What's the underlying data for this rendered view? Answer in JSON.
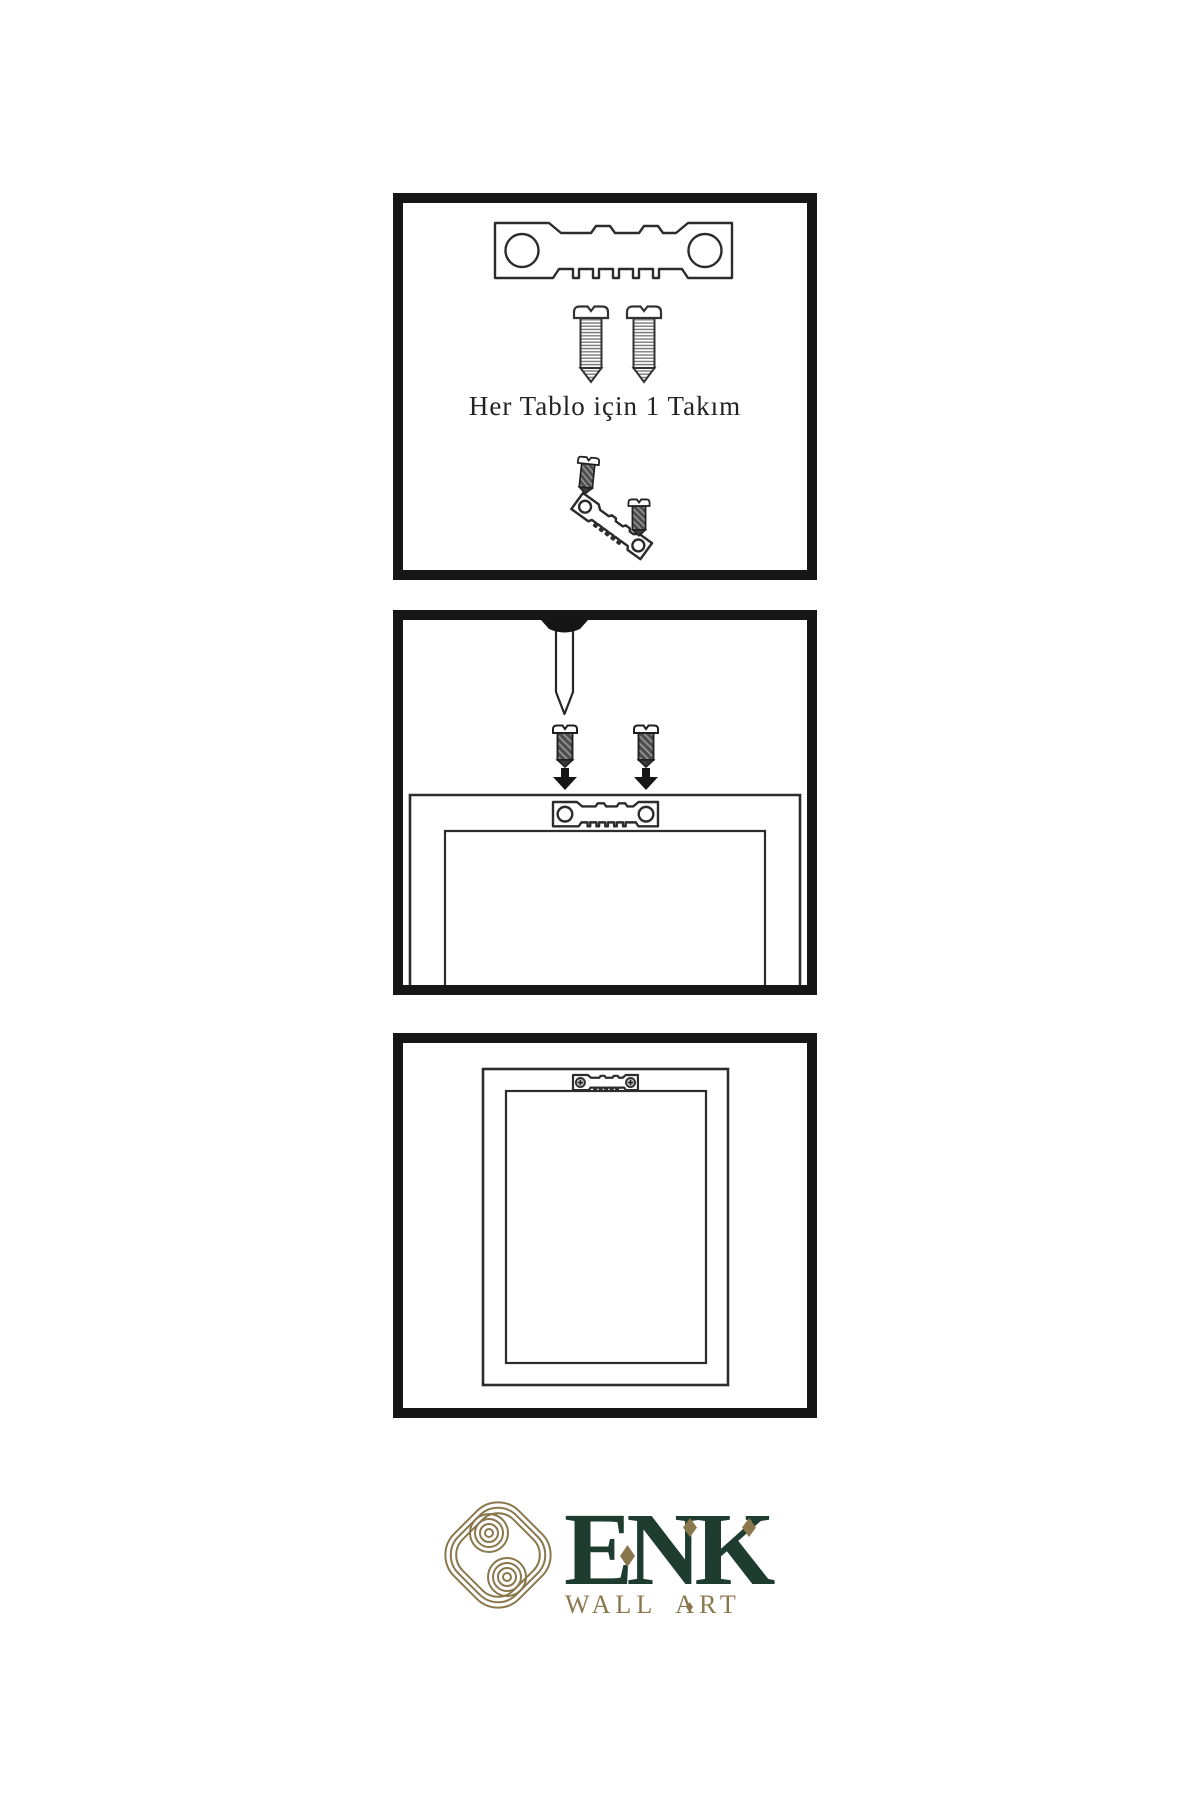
{
  "panels": {
    "kit": {
      "caption": "Her Tablo için 1 Takım",
      "icons": [
        "sawtooth-hanger-icon",
        "screw-icon",
        "screw-icon",
        "tilted-hanger-with-screws-icon"
      ]
    },
    "attach": {
      "icons": [
        "wall-nail-icon",
        "dark-screw-icon",
        "dark-screw-icon",
        "down-arrow-icon",
        "down-arrow-icon",
        "frame-back-with-hanger-icon"
      ]
    },
    "hang": {
      "icons": [
        "frame-back-icon",
        "mounted-hanger-with-screws-icon"
      ]
    }
  },
  "logo": {
    "name": "ENK",
    "tagline": "WALL ART",
    "mark": "celtic-knot-icon"
  },
  "colors": {
    "ink": "#1c1c1c",
    "panel_border": "#161616",
    "logo_green": "#1e3c30",
    "logo_gold": "#8a784c",
    "background": "#ffffff"
  }
}
